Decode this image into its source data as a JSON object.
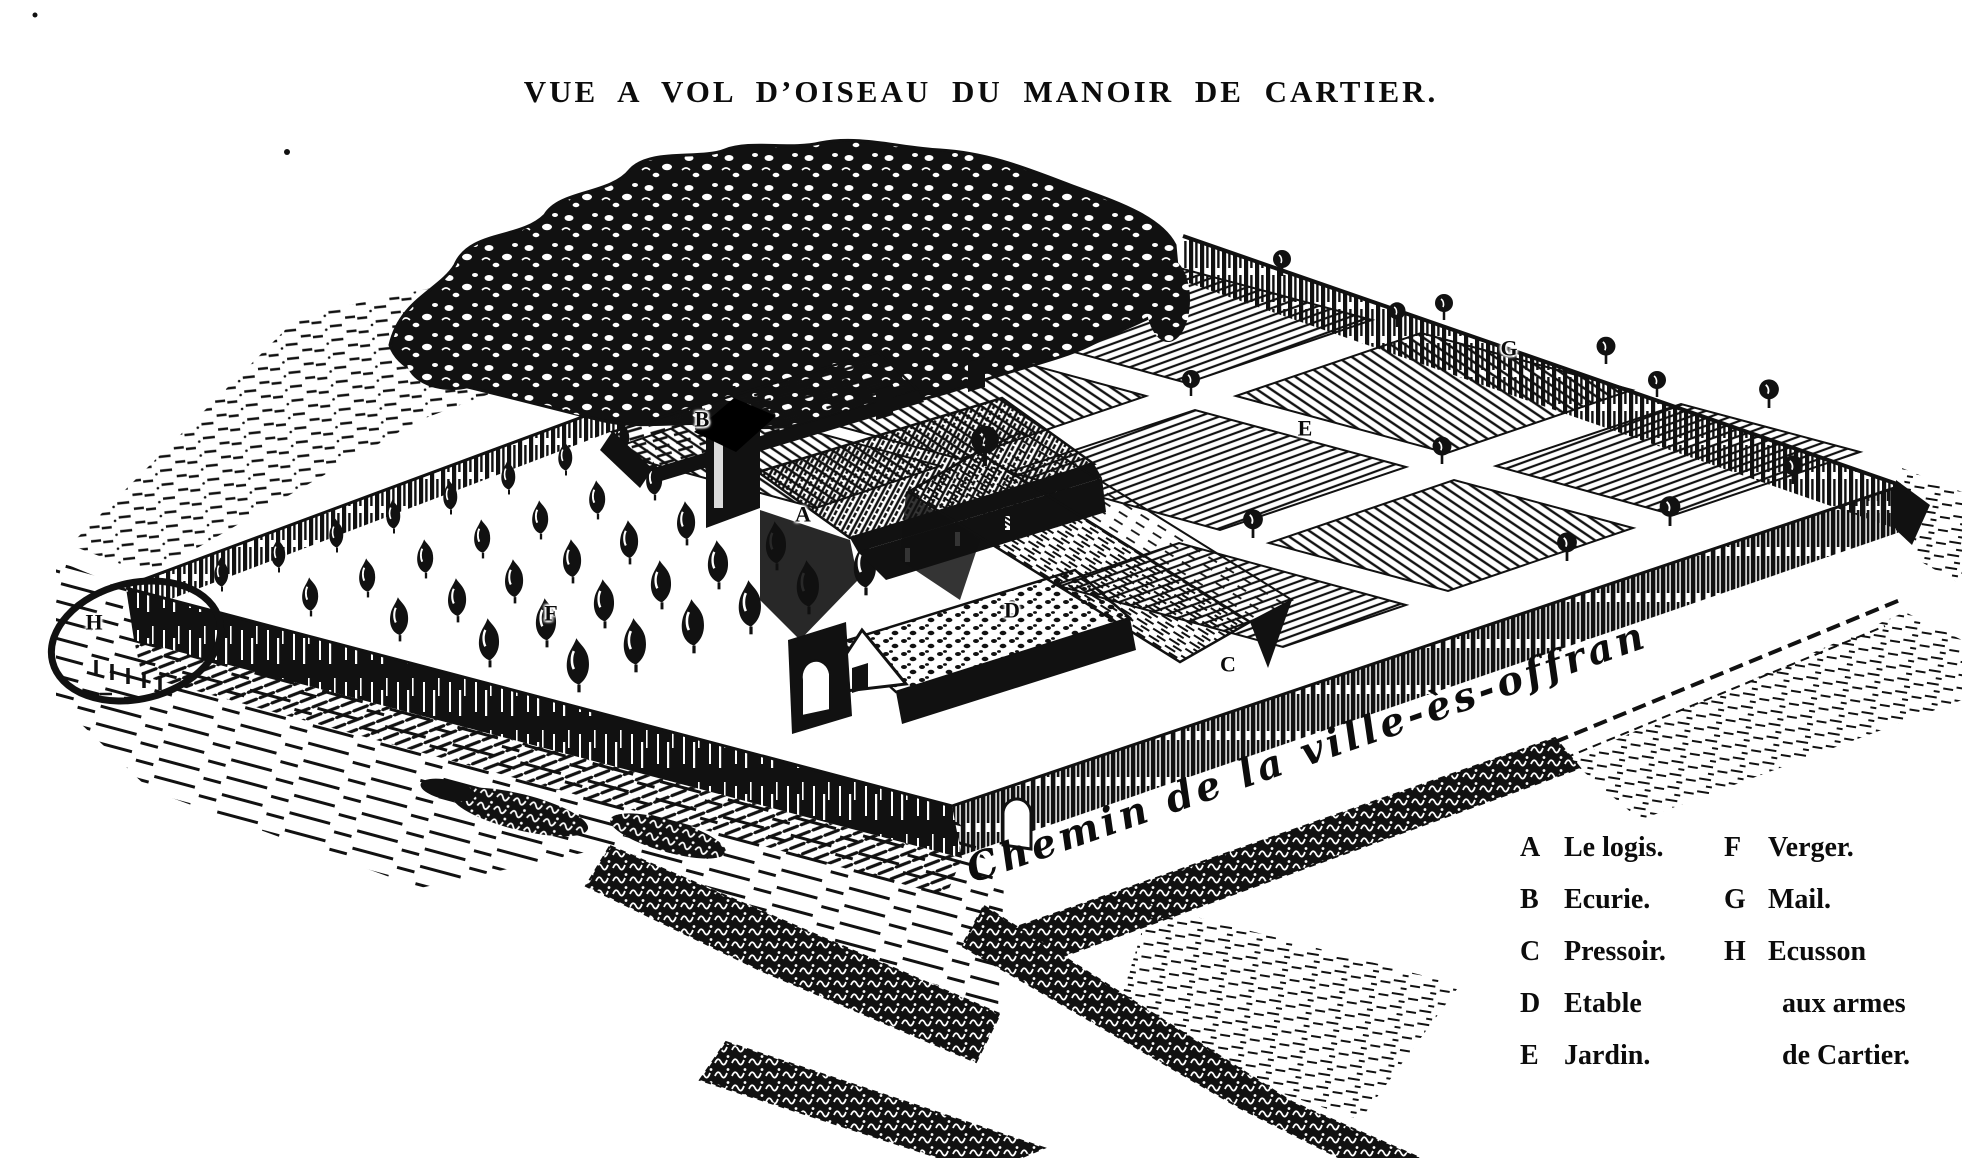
{
  "title": "VUE A VOL D’OISEAU DU MANOIR DE CARTIER.",
  "road_label": "Chemin de la ville-ès-offran",
  "legend": {
    "col1": [
      {
        "key": "A",
        "label": "Le logis."
      },
      {
        "key": "B",
        "label": "Ecurie."
      },
      {
        "key": "C",
        "label": "Pressoir."
      },
      {
        "key": "D",
        "label": "Etable"
      },
      {
        "key": "E",
        "label": "Jardin."
      }
    ],
    "col2": [
      {
        "key": "F",
        "label": "Verger."
      },
      {
        "key": "G",
        "label": "Mail."
      },
      {
        "key": "H",
        "label": "Ecusson"
      },
      {
        "key": "",
        "label": "aux armes"
      },
      {
        "key": "",
        "label": "de Cartier."
      }
    ]
  },
  "plan_markers": [
    {
      "letter": "A",
      "x": 803,
      "y": 516
    },
    {
      "letter": "B",
      "x": 702,
      "y": 421
    },
    {
      "letter": "C",
      "x": 1228,
      "y": 666
    },
    {
      "letter": "D",
      "x": 1012,
      "y": 612
    },
    {
      "letter": "E",
      "x": 1305,
      "y": 430
    },
    {
      "letter": "F",
      "x": 551,
      "y": 615
    },
    {
      "letter": "G",
      "x": 1509,
      "y": 350
    },
    {
      "letter": "H",
      "x": 94,
      "y": 624
    }
  ],
  "colors": {
    "ink": "#0c0c0c",
    "paper": "#ffffff"
  }
}
